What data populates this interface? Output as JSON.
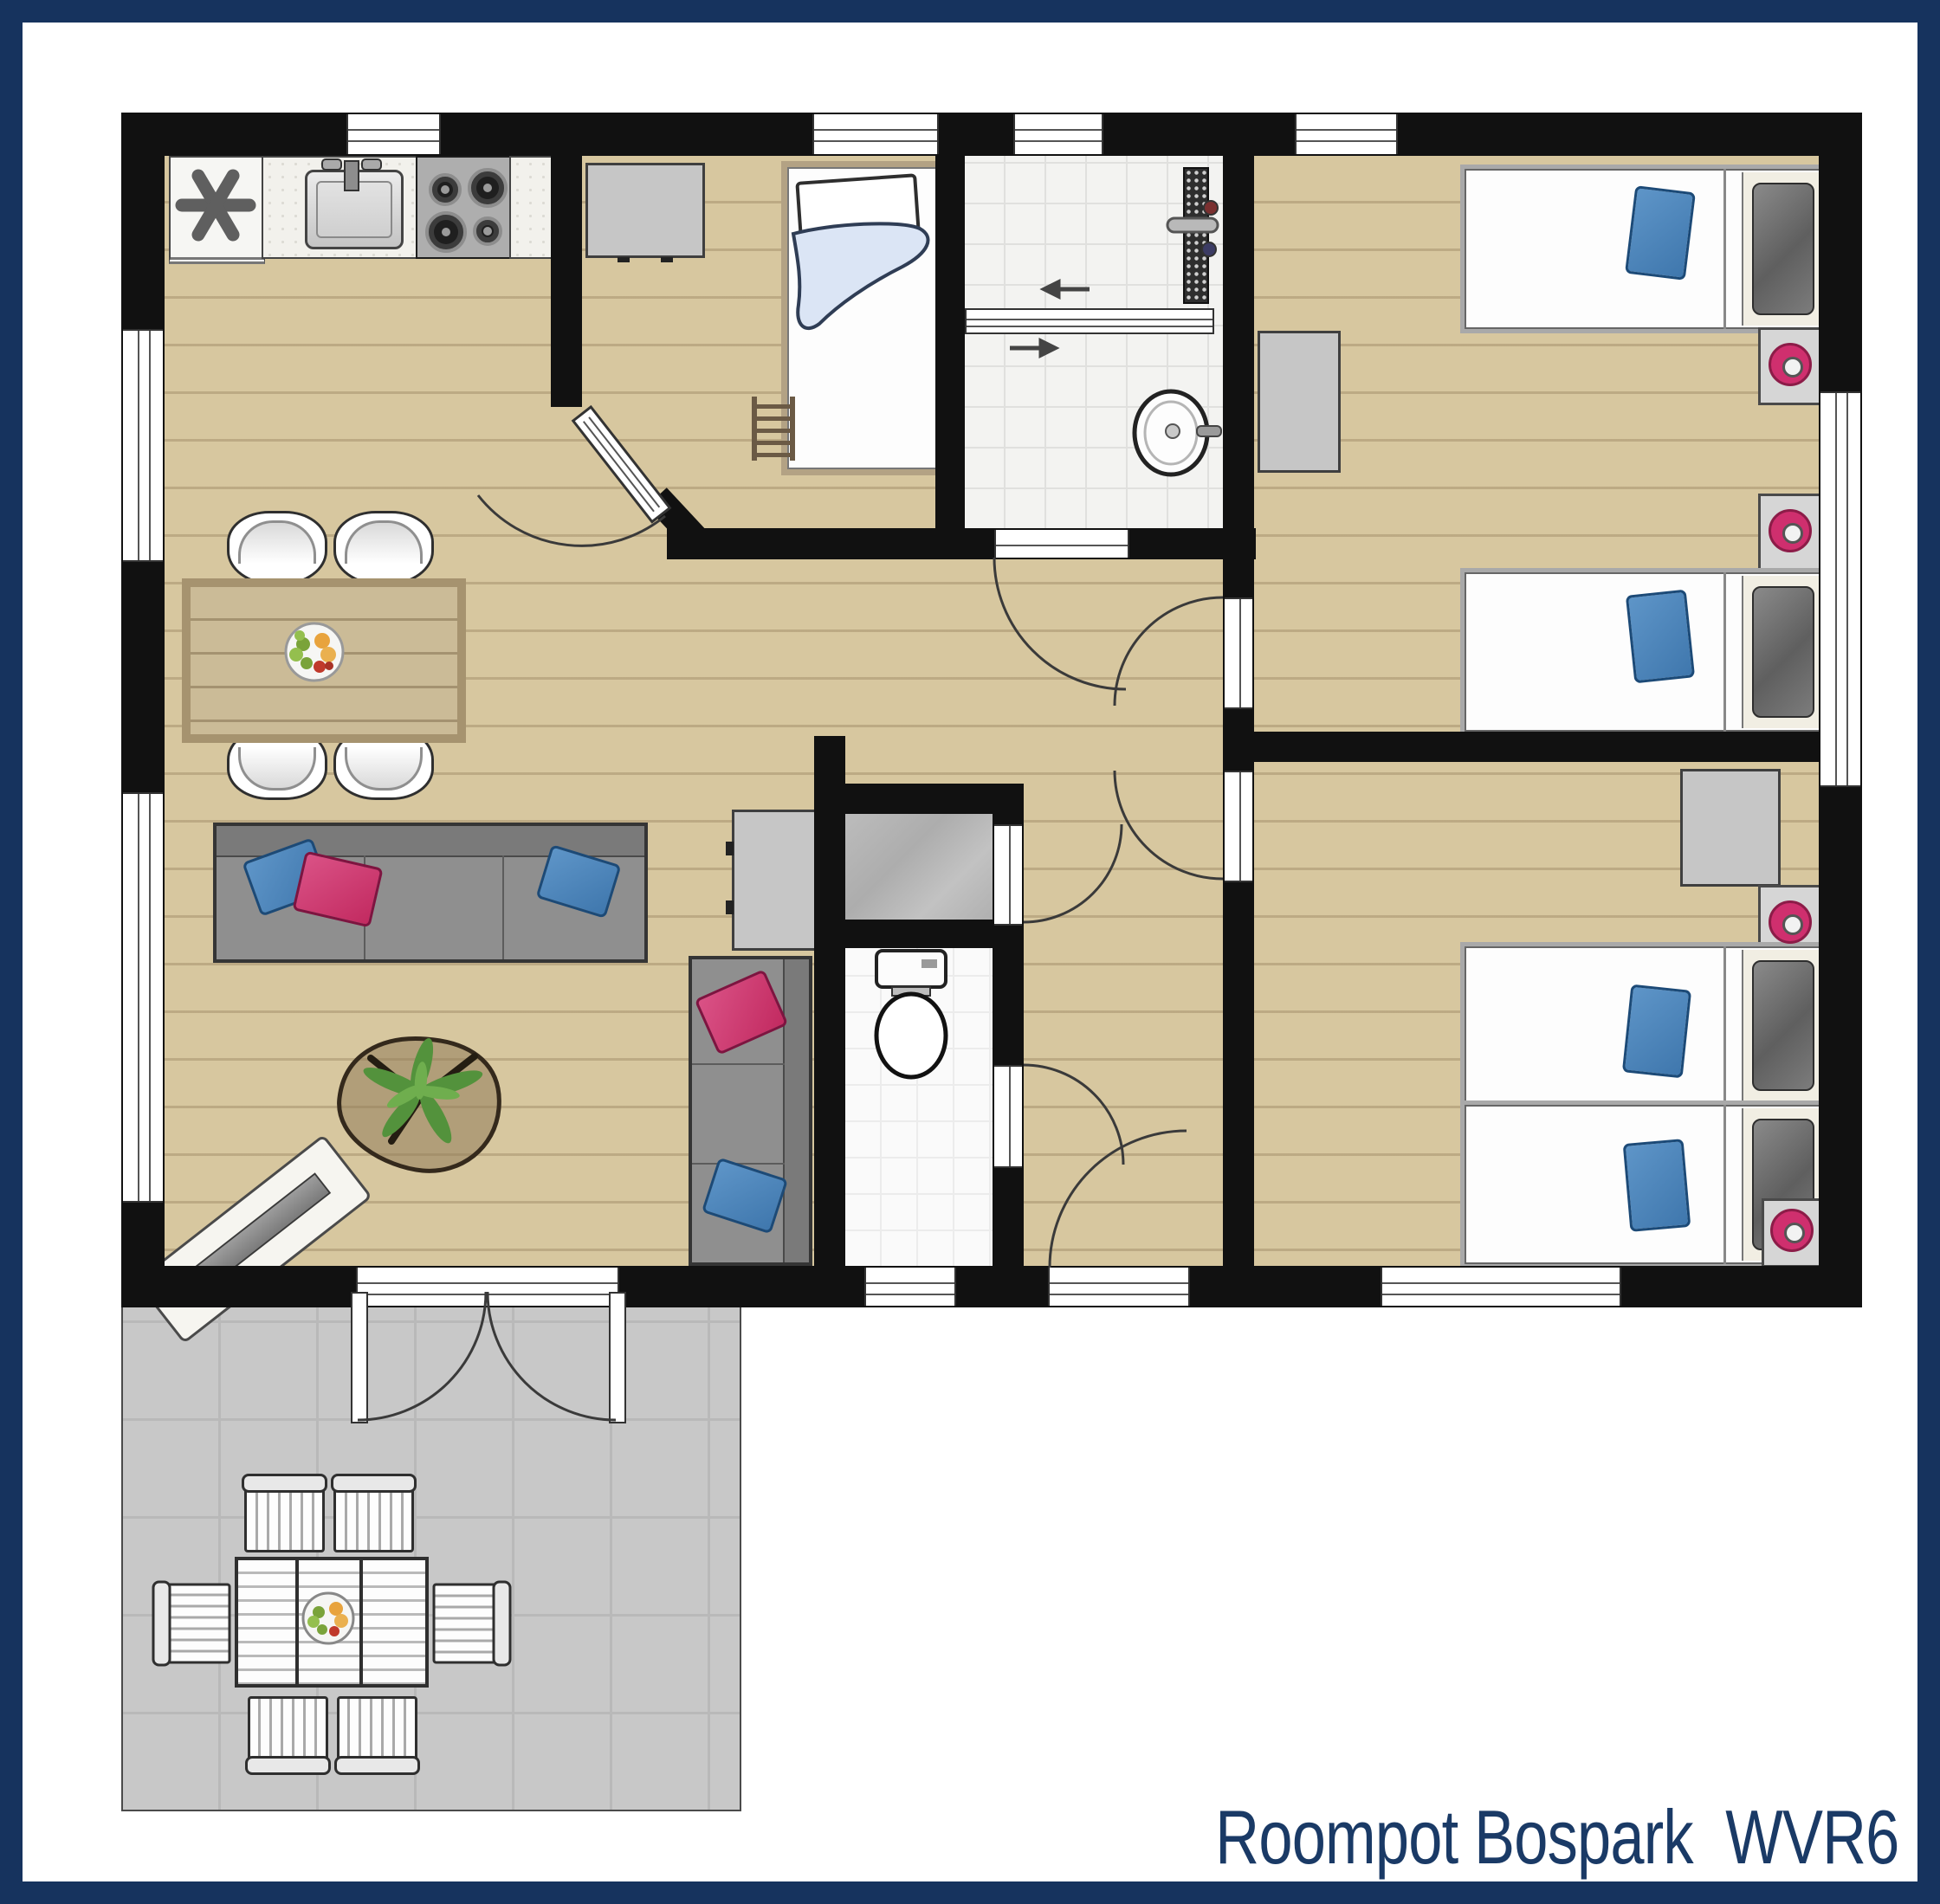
{
  "title": {
    "text": "Roompot Bospark  WVR6"
  },
  "colors": {
    "frame_navy": "#16335e",
    "title_navy": "#1a3a66",
    "wall_black": "#111111",
    "wood_floor": "#d7c79f",
    "terrace_gray": "#c8c8c8",
    "sofa_gray": "#8f8f8f",
    "pillow_blue": "#3f77ad",
    "pillow_pink": "#c22a60",
    "lamp_pink": "#cf2f6e",
    "plant_green": "#53923c",
    "bed_blanket_blue": "#dbe5f5"
  },
  "icons": [
    "freezer-star-icon",
    "kitchen-sink-icon",
    "stove-burners-icon",
    "shower-drain-icon",
    "shower-mixer-icon",
    "sliding-door-arrow-icon",
    "washbasin-icon",
    "toilet-icon",
    "tv-sideboard-icon",
    "fruit-bowl-icon",
    "plant-icon",
    "bed-ladder-icon",
    "lamp-icon"
  ]
}
